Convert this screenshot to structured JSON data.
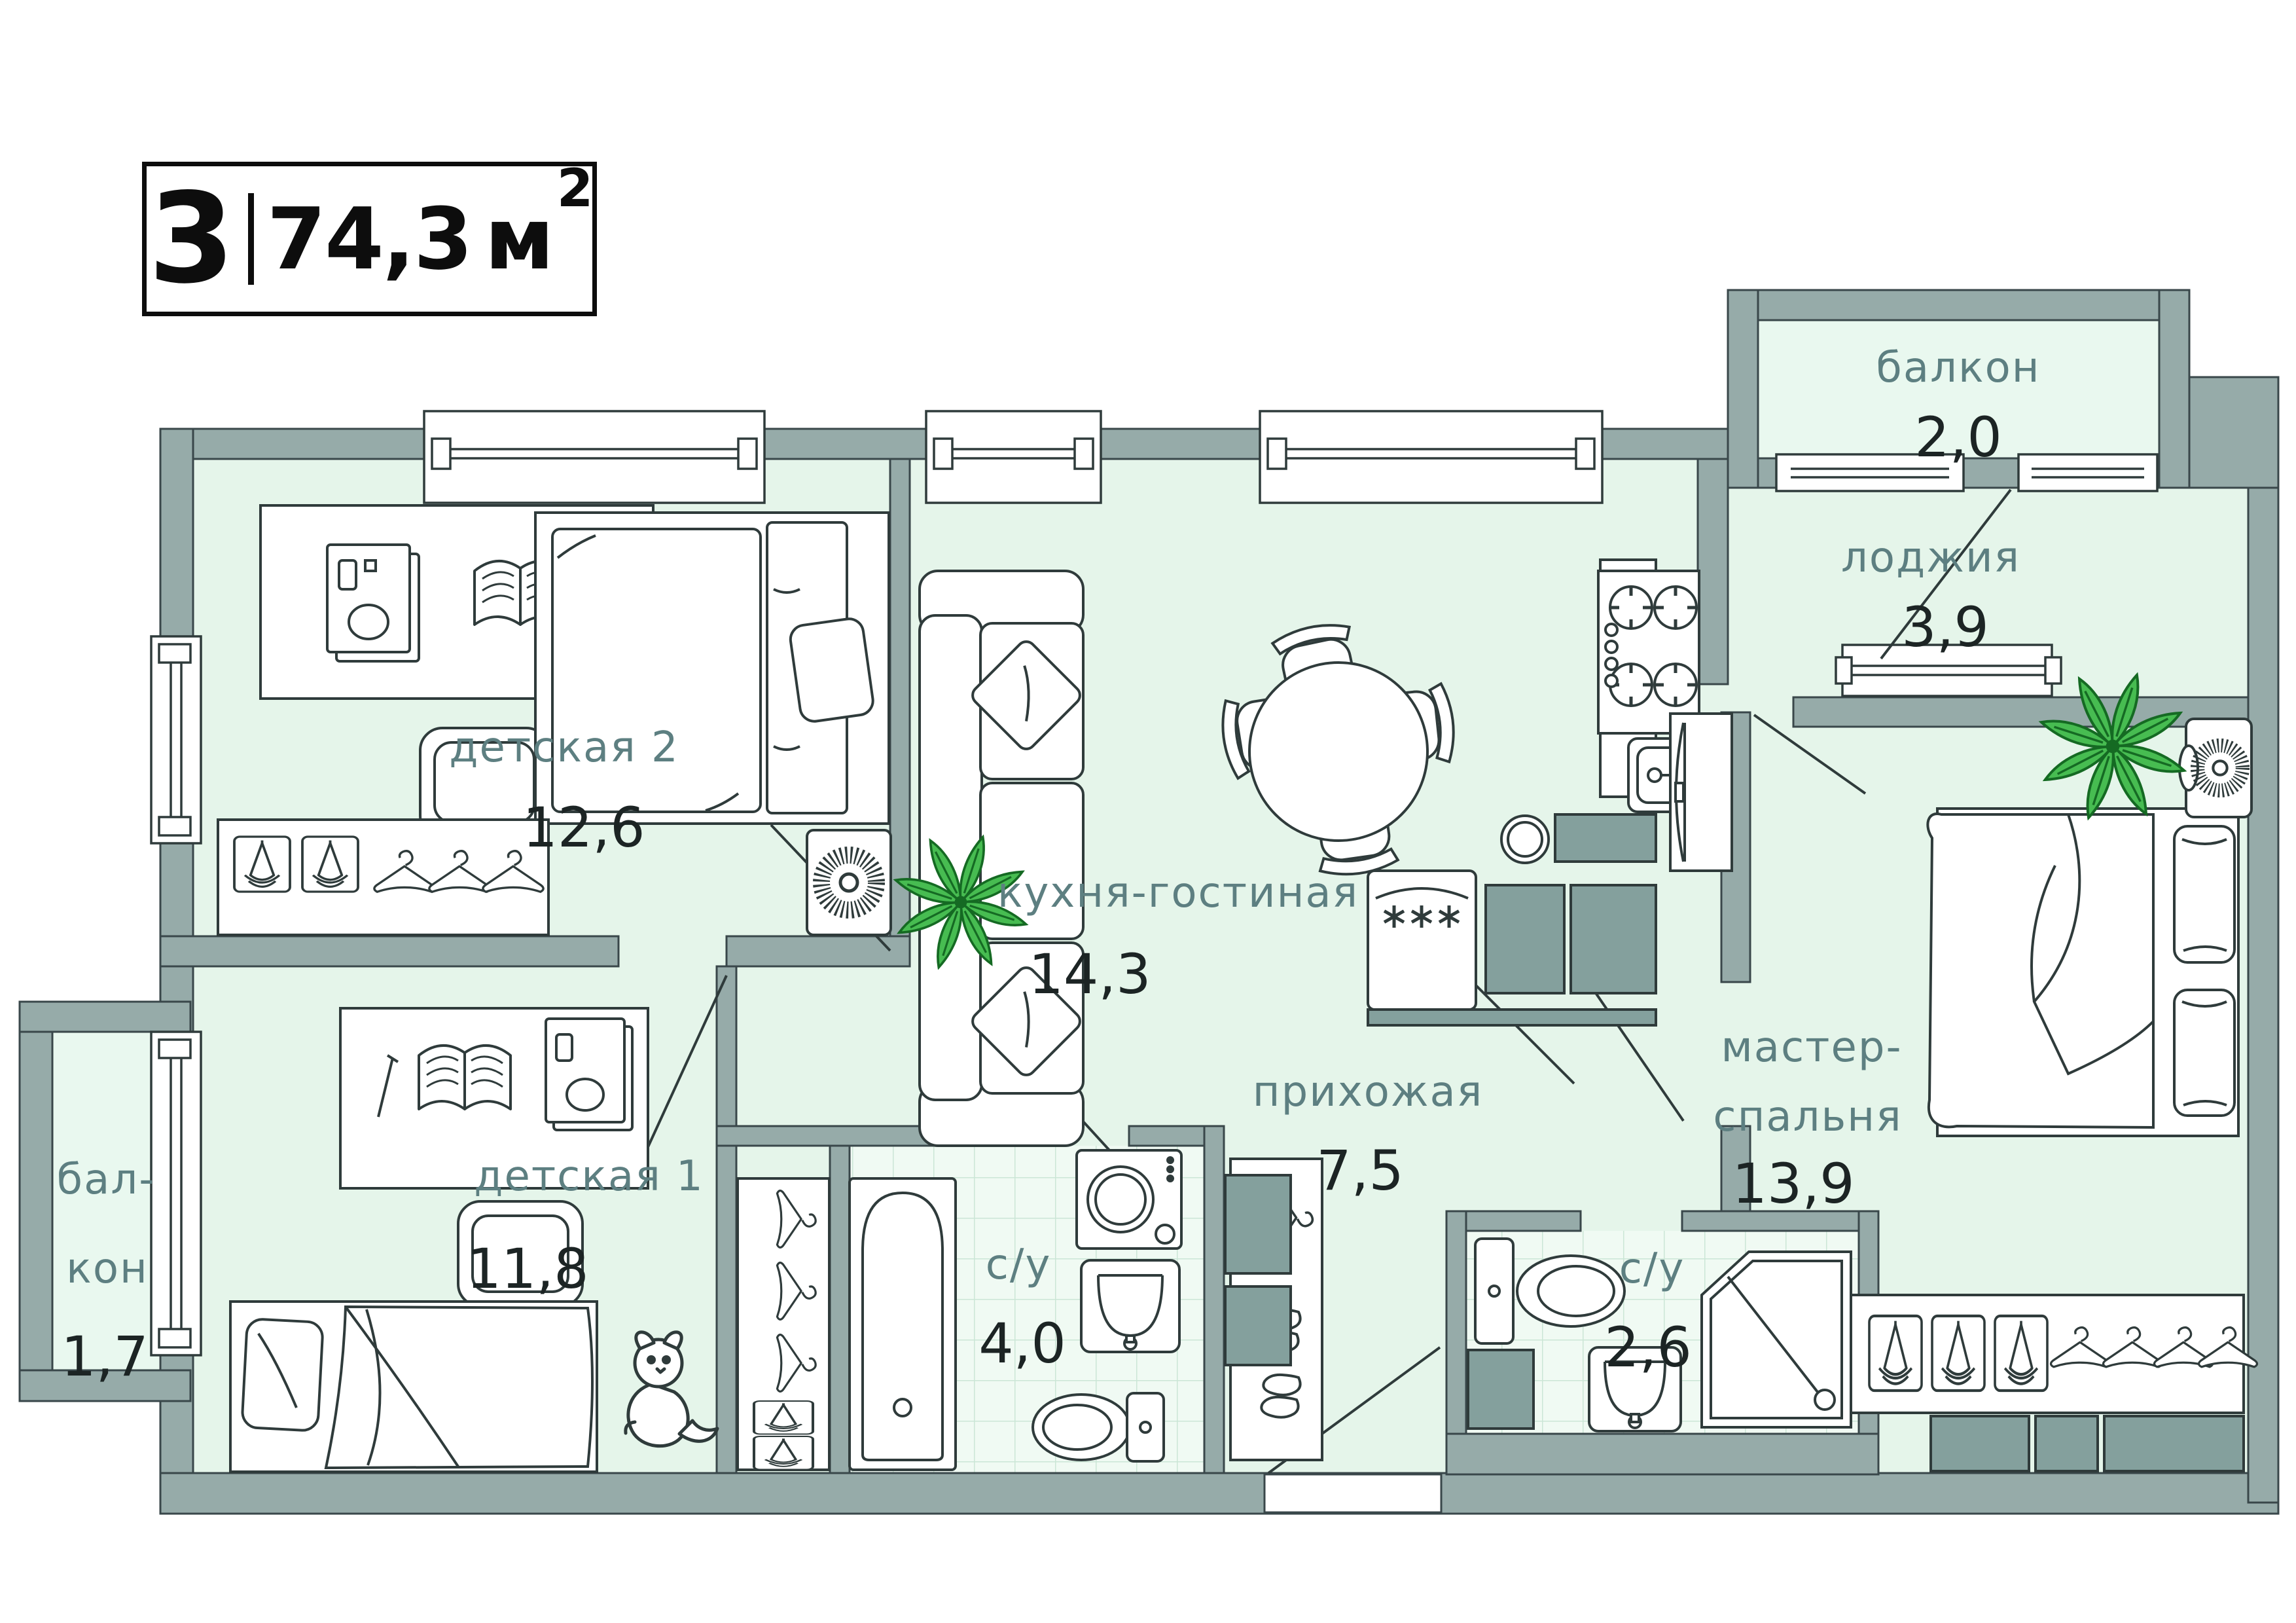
{
  "badge": {
    "rooms_count": "3",
    "area_value": "74,3",
    "area_unit": "м",
    "area_sup": "2"
  },
  "rooms": [
    {
      "key": "balcony_top",
      "name": "балкон",
      "area": "2,0"
    },
    {
      "key": "loggia",
      "name": "лоджия",
      "area": "3,9"
    },
    {
      "key": "nursery2",
      "name": "детская 2",
      "area": "12,6"
    },
    {
      "key": "kitchen_living",
      "name": "кухня-гостиная",
      "area": "14,3"
    },
    {
      "key": "master_bedroom",
      "name_line1": "мастер-",
      "name_line2": "спальня",
      "area": "13,9"
    },
    {
      "key": "nursery1",
      "name": "детская 1",
      "area": "11,8"
    },
    {
      "key": "balcony_left",
      "name_line1": "бал-",
      "name_line2": "кон",
      "area": "1,7"
    },
    {
      "key": "hallway",
      "name": "прихожая",
      "area": "7,5"
    },
    {
      "key": "bathroom_main",
      "name": "с/у",
      "area": "4,0"
    },
    {
      "key": "bathroom_master",
      "name": "с/у",
      "area": "2,6"
    }
  ],
  "colors": {
    "wall": "#96ABA9",
    "wall_outline": "#39474A",
    "floor": "#E5F5EA",
    "balcony_floor": "#E9F8EF",
    "tile_floor": "#F0FAF3",
    "tile_grid": "#CBE6D6",
    "room_name_text": "#5D7F81",
    "room_area_text": "#1C2424",
    "plant_green": "#47BC51",
    "plant_dark": "#156A23",
    "cabinet_gray": "#84A09D",
    "line": "#2F3B3B"
  },
  "icons": [
    "plant-icon",
    "speaker-icon",
    "single-bed-icon",
    "double-bed-icon",
    "sofa-icon",
    "pillow-icon",
    "dining-table-icon",
    "dining-chair-icon",
    "stove-icon",
    "kitchen-counter-icon",
    "kitchen-sink-icon",
    "fridge-icon",
    "snowflake-icon",
    "plate-icon",
    "bathtub-icon",
    "washing-machine-icon",
    "washbasin-icon",
    "toilet-icon",
    "shower-icon",
    "wardrobe-icon",
    "hanger-icon",
    "storage-box-icon",
    "shoes-icon",
    "desk-icon",
    "armchair-icon",
    "laptop-icon",
    "book-icon",
    "pen-icon",
    "dog-icon",
    "window-icon",
    "door-swing-icon",
    "radiator-icon",
    "sliding-wardrobe-icon"
  ]
}
